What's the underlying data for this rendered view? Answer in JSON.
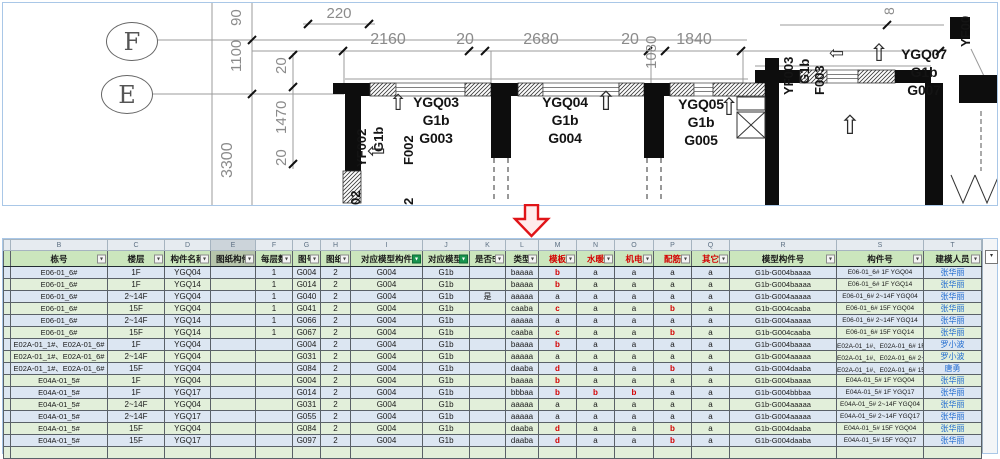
{
  "drawing": {
    "grid_bubbles": [
      "F",
      "E"
    ],
    "top_dims": [
      "220",
      "2160",
      "20",
      "2680",
      "20",
      "1080",
      "1840",
      "8"
    ],
    "left_dims": [
      "90",
      "1100",
      "20",
      "1470",
      "20",
      "3300"
    ],
    "room_labels": {
      "ygq03": [
        "YGQ03",
        "G1b",
        "G003"
      ],
      "ygq04": [
        "YGQ04",
        "G1b",
        "G004"
      ],
      "ygq05": [
        "YGQ05",
        "G1b",
        "G005"
      ],
      "ygq07": [
        "YGQ07",
        "G1b",
        "G007"
      ]
    },
    "wall_tags": {
      "yf002": [
        "YF002",
        "G1b",
        "F002"
      ],
      "yf003": [
        "YF003",
        "G1b",
        "F003"
      ],
      "edge": "YF00",
      "cut_a": "02",
      "cut_b": "2"
    }
  },
  "table": {
    "column_letters": [
      "B",
      "C",
      "D",
      "E",
      "F",
      "G",
      "H",
      "I",
      "J",
      "K",
      "L",
      "M",
      "N",
      "O",
      "P",
      "Q",
      "R",
      "S",
      "T"
    ],
    "selected_letter": "E",
    "headers": [
      {
        "label": "栋号",
        "filter": "normal"
      },
      {
        "label": "楼层",
        "filter": "normal"
      },
      {
        "label": "构件名称",
        "filter": "normal"
      },
      {
        "label": "图纸构件加模",
        "filter": "normal",
        "selected": true
      },
      {
        "label": "每层数量",
        "filter": "normal"
      },
      {
        "label": "图号",
        "filter": "normal"
      },
      {
        "label": "图纸数",
        "filter": "normal"
      },
      {
        "label": "对应模型构件",
        "filter": "active"
      },
      {
        "label": "对应模型区",
        "filter": "active"
      },
      {
        "label": "是否5a建模",
        "filter": "normal"
      },
      {
        "label": "类型",
        "filter": "normal"
      },
      {
        "label": "模板",
        "filter": "normal",
        "red": true
      },
      {
        "label": "水暖",
        "filter": "normal",
        "red": true
      },
      {
        "label": "机电",
        "filter": "normal",
        "red": true
      },
      {
        "label": "配筋",
        "filter": "normal",
        "red": true
      },
      {
        "label": "其它",
        "filter": "normal",
        "red": true
      },
      {
        "label": "模型构件号",
        "filter": "normal"
      },
      {
        "label": "构件号",
        "filter": "normal"
      },
      {
        "label": "建模人员",
        "filter": "normal"
      }
    ],
    "rows": [
      [
        "E06-01_6#",
        "1F",
        "YGQ04",
        "",
        "1",
        "G004",
        "2",
        "G004",
        "G1b",
        "",
        "baaaa",
        "b",
        "a",
        "a",
        "a",
        "a",
        "G1b-G004baaaa",
        "E06-01_6# 1F YGQ04",
        "张华丽"
      ],
      [
        "E06-01_6#",
        "1F",
        "YGQ14",
        "",
        "1",
        "G014",
        "2",
        "G004",
        "G1b",
        "",
        "baaaa",
        "b",
        "a",
        "a",
        "a",
        "a",
        "G1b-G004baaaa",
        "E06-01_6# 1F YGQ14",
        "张华丽"
      ],
      [
        "E06-01_6#",
        "2~14F",
        "YGQ04",
        "",
        "1",
        "G040",
        "2",
        "G004",
        "G1b",
        "是",
        "aaaaa",
        "a",
        "a",
        "a",
        "a",
        "a",
        "G1b-G004aaaaa",
        "E06-01_6# 2~14F YGQ04",
        "张华丽"
      ],
      [
        "E06-01_6#",
        "15F",
        "YGQ04",
        "",
        "1",
        "G041",
        "2",
        "G004",
        "G1b",
        "",
        "caaba",
        "c",
        "a",
        "a",
        "b",
        "a",
        "G1b-G004caaba",
        "E06-01_6# 15F YGQ04",
        "张华丽"
      ],
      [
        "E06-01_6#",
        "2~14F",
        "YGQ14",
        "",
        "1",
        "G066",
        "2",
        "G004",
        "G1b",
        "",
        "aaaaa",
        "a",
        "a",
        "a",
        "a",
        "a",
        "G1b-G004aaaaa",
        "E06-01_6# 2~14F YGQ14",
        "张华丽"
      ],
      [
        "E06-01_6#",
        "15F",
        "YGQ14",
        "",
        "1",
        "G067",
        "2",
        "G004",
        "G1b",
        "",
        "caaba",
        "c",
        "a",
        "a",
        "b",
        "a",
        "G1b-G004caaba",
        "E06-01_6# 15F YGQ14",
        "张华丽"
      ],
      [
        "E02A-01_1#、E02A-01_6#",
        "1F",
        "YGQ04",
        "",
        "",
        "G004",
        "2",
        "G004",
        "G1b",
        "",
        "baaaa",
        "b",
        "a",
        "a",
        "a",
        "a",
        "G1b-G004baaaa",
        "E02A-01_1#、E02A-01_6# 1F YGQ04",
        "罗小波"
      ],
      [
        "E02A-01_1#、E02A-01_6#",
        "2~14F",
        "YGQ04",
        "",
        "",
        "G031",
        "2",
        "G004",
        "G1b",
        "",
        "aaaaa",
        "a",
        "a",
        "a",
        "a",
        "a",
        "G1b-G004aaaaa",
        "E02A-01_1#、E02A-01_6# 2~14F YGQ04",
        "罗小波"
      ],
      [
        "E02A-01_1#、E02A-01_6#",
        "15F",
        "YGQ04",
        "",
        "",
        "G084",
        "2",
        "G004",
        "G1b",
        "",
        "daaba",
        "d",
        "a",
        "a",
        "b",
        "a",
        "G1b-G004daaba",
        "E02A-01_1#、E02A-01_6# 15F YGQ04",
        "唐勇"
      ],
      [
        "E04A-01_5#",
        "1F",
        "YGQ04",
        "",
        "",
        "G004",
        "2",
        "G004",
        "G1b",
        "",
        "baaaa",
        "b",
        "a",
        "a",
        "a",
        "a",
        "G1b-G004baaaa",
        "E04A-01_5# 1F YGQ04",
        "张华丽"
      ],
      [
        "E04A-01_5#",
        "1F",
        "YGQ17",
        "",
        "",
        "G014",
        "2",
        "G004",
        "G1b",
        "",
        "bbbaa",
        "b",
        "b",
        "b",
        "a",
        "a",
        "G1b-G004bbbaa",
        "E04A-01_5# 1F YGQ17",
        "张华丽"
      ],
      [
        "E04A-01_5#",
        "2~14F",
        "YGQ04",
        "",
        "",
        "G031",
        "2",
        "G004",
        "G1b",
        "",
        "aaaaa",
        "a",
        "a",
        "a",
        "a",
        "a",
        "G1b-G004aaaaa",
        "E04A-01_5# 2~14F YGQ04",
        "张华丽"
      ],
      [
        "E04A-01_5#",
        "2~14F",
        "YGQ17",
        "",
        "",
        "G055",
        "2",
        "G004",
        "G1b",
        "",
        "aaaaa",
        "a",
        "a",
        "a",
        "a",
        "a",
        "G1b-G004aaaaa",
        "E04A-01_5# 2~14F YGQ17",
        "张华丽"
      ],
      [
        "E04A-01_5#",
        "15F",
        "YGQ04",
        "",
        "",
        "G084",
        "2",
        "G004",
        "G1b",
        "",
        "daaba",
        "d",
        "a",
        "a",
        "b",
        "a",
        "G1b-G004daaba",
        "E04A-01_5# 15F YGQ04",
        "张华丽"
      ],
      [
        "E04A-01_5#",
        "15F",
        "YGQ17",
        "",
        "",
        "G097",
        "2",
        "G004",
        "G1b",
        "",
        "daaba",
        "d",
        "a",
        "a",
        "b",
        "a",
        "G1b-G004daaba",
        "E04A-01_5# 15F YGQ17",
        "张华丽"
      ],
      [
        "",
        "",
        "",
        "",
        "",
        "",
        "",
        "",
        "",
        "",
        "",
        "",
        "",
        "",
        "",
        "",
        "",
        "",
        ""
      ]
    ]
  },
  "colors": {
    "row_blue": "#dce6f2",
    "row_green": "#e2efda",
    "header_green": "#cbe6bd",
    "alert_red": "#d40000",
    "name_blue": "#1f6bd0",
    "panel_border_blue": "#a9c7e7",
    "arrow_red": "#e01418"
  }
}
